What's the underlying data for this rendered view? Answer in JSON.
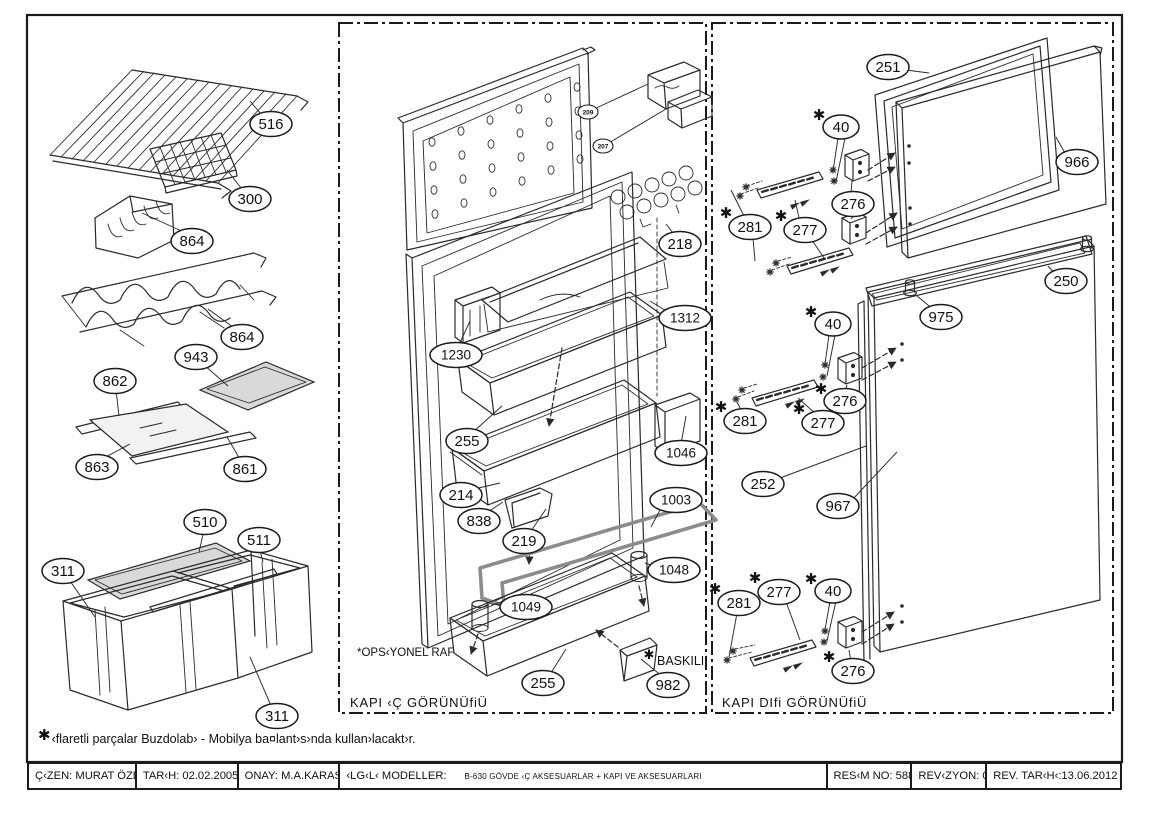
{
  "document": {
    "type": "exploded-parts-drawing",
    "footnote": {
      "star": "✱",
      "text": "‹flaretli parçalar Buzdolab› - Mobilya ba¤lant›s›nda kullan›lacakt›r."
    },
    "titleblock": {
      "cells": [
        {
          "text": "Ç‹ZEN: MURAT ÖZDEN"
        },
        {
          "text": "TAR‹H: 02.02.2005"
        },
        {
          "text": "ONAY: M.A.KARASU"
        },
        {
          "text": "‹LG‹L‹ MODELLER:",
          "value": "B-630 GÖVDE ‹Ç AKSESUARLAR + KAPI VE AKSESUARLARI"
        },
        {
          "text": "RES‹M NO: 588"
        },
        {
          "text": "REV‹ZYON: 03"
        },
        {
          "text": "REV. TAR‹H‹:13.06.2012"
        }
      ]
    }
  },
  "panels": {
    "inner": {
      "caption": "KAPI ‹Ç GÖRÜNÜfiÜ",
      "optional_note": "*OPS‹YONEL RAF",
      "printed_note_star": "✱",
      "printed_note": "BASKILI"
    },
    "outer": {
      "caption": "KAPI DIfi GÖRÜNÜfiÜ"
    }
  },
  "colors": {
    "line": "#2a2a2a",
    "glass": "#d9d9d9",
    "wire_gray": "#8c8c8c"
  },
  "callouts": {
    "left": [
      {
        "label": "516"
      },
      {
        "label": "300"
      },
      {
        "label": "864"
      },
      {
        "label": "864"
      },
      {
        "label": "943"
      },
      {
        "label": "862"
      },
      {
        "label": "863"
      },
      {
        "label": "861"
      },
      {
        "label": "510"
      },
      {
        "label": "511"
      },
      {
        "label": "311"
      },
      {
        "label": "311"
      }
    ],
    "inner": [
      {
        "label": "209"
      },
      {
        "label": "207"
      },
      {
        "label": "218"
      },
      {
        "label": "1312"
      },
      {
        "label": "1230"
      },
      {
        "label": "255"
      },
      {
        "label": "1046"
      },
      {
        "label": "214"
      },
      {
        "label": "838"
      },
      {
        "label": "219"
      },
      {
        "label": "1003"
      },
      {
        "label": "1048"
      },
      {
        "label": "1049"
      },
      {
        "label": "255"
      },
      {
        "label": "982"
      }
    ],
    "outer": [
      {
        "label": "251"
      },
      {
        "label": "966"
      },
      {
        "label": "40",
        "star": "✱"
      },
      {
        "label": "276"
      },
      {
        "label": "281",
        "star": "✱"
      },
      {
        "label": "277",
        "star": "✱"
      },
      {
        "label": "250"
      },
      {
        "label": "975"
      },
      {
        "label": "40",
        "star": "✱"
      },
      {
        "label": "276",
        "star": "✱"
      },
      {
        "label": "281",
        "star": "✱"
      },
      {
        "label": "277",
        "star": "✱"
      },
      {
        "label": "252"
      },
      {
        "label": "967"
      },
      {
        "label": "277",
        "star": "✱"
      },
      {
        "label": "40",
        "star": "✱"
      },
      {
        "label": "281",
        "star": "✱"
      },
      {
        "label": "276",
        "star": "✱"
      }
    ]
  }
}
